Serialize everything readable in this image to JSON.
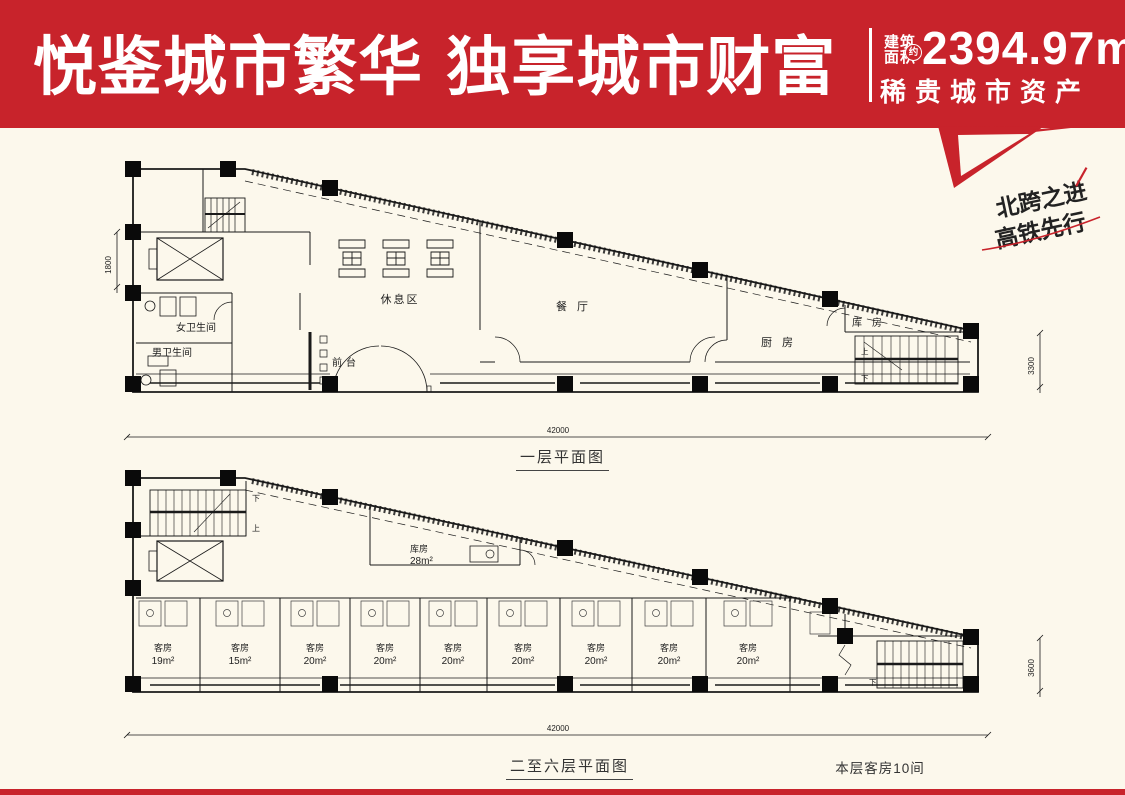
{
  "colors": {
    "accent_red": "#c8232b",
    "background": "#fcf8ec",
    "plan_line": "#1a1a1a"
  },
  "header": {
    "title": "悦鉴城市繁华 独享城市财富",
    "area_label_line1": "建筑",
    "area_label_line2": "面积",
    "area_approx": "约",
    "area_value": "2394.97m",
    "area_sup": "2",
    "subtitle": "稀贵城市资产"
  },
  "ribbon": {
    "line1": "北跨之进",
    "line2": "高铁先行"
  },
  "floor1": {
    "caption": "一层平面图",
    "labels": {
      "rest_area": "休息区",
      "dining": "餐厅",
      "kitchen": "厨房",
      "storage": "库房",
      "front_desk": "前台",
      "women_wc": "女卫生间",
      "men_wc": "男卫生间"
    },
    "stairs": {
      "up": "上",
      "down": "下"
    },
    "dims": {
      "bottom": "42000",
      "right": "3300",
      "left": "1800"
    }
  },
  "floor2": {
    "caption": "二至六层平面图",
    "note": "本层客房10间",
    "storage": {
      "name": "库房",
      "area": "28m²"
    },
    "stairs": {
      "up": "上",
      "down": "下"
    },
    "dims": {
      "bottom": "42000",
      "right": "3600"
    },
    "rooms": [
      {
        "name": "客房",
        "area": "19m²"
      },
      {
        "name": "客房",
        "area": "15m²"
      },
      {
        "name": "客房",
        "area": "20m²"
      },
      {
        "name": "客房",
        "area": "20m²"
      },
      {
        "name": "客房",
        "area": "20m²"
      },
      {
        "name": "客房",
        "area": "20m²"
      },
      {
        "name": "客房",
        "area": "20m²"
      },
      {
        "name": "客房",
        "area": "20m²"
      },
      {
        "name": "客房",
        "area": "20m²"
      }
    ]
  }
}
